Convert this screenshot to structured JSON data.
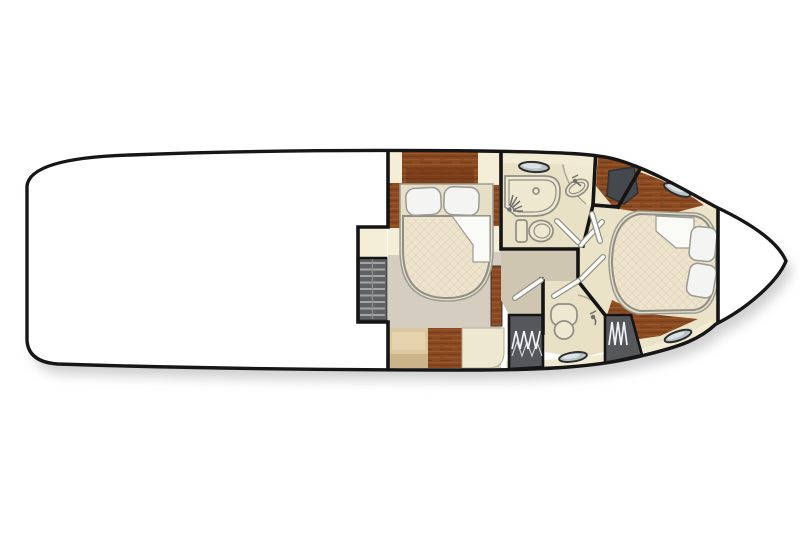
{
  "meta": {
    "title": "Motor yacht lower-deck floor plan, top view with bow facing right",
    "type": "yacht-floor-plan"
  },
  "colors": {
    "hull_fill": "#ffffff",
    "hull_outline": "#161616",
    "shadow": "#a0a0a0",
    "wall": "#141414",
    "floor_mid": "#d5cec0",
    "floor_hall": "#cfc6b2",
    "floor_bath": "#e9e1c5",
    "walkway_cream": "#ebe3c8",
    "square_cream": "#f4eed6",
    "counter_cream": "#f0e9d0",
    "trim_cream": "#f1ebd3",
    "wood": "#8a4a22",
    "wood_dark": "#6e3414",
    "wood_light": "#a65e2e",
    "locker_dark": "#45484c",
    "mattress": "#eee4cd",
    "mattress_line": "#d6cbad",
    "mattress_edge": "#8f8f85",
    "mat_ring": "#e7dec6",
    "pillow": "#f4f4f2",
    "pillow_outline": "#9a9a92",
    "fixture_fill": "#efe8d0",
    "fixture_outline": "#8f8f85",
    "door_leaf": "#fbfbf9",
    "stair_bg": "#5f6163",
    "stair_tread": "#a3a5a7",
    "spring_bg": "#55575b",
    "spring_coil": "#f2f2f2",
    "porthole_rim": "#2e2e2e",
    "porthole_glass": "#b9c3c7",
    "porthole_hi": "#dfe7e9",
    "bench_tan": "#dcc8a0",
    "bench_light": "#e6d4ae",
    "bench_dark": "#cdb389"
  },
  "rooms": [
    {
      "id": "aft-area",
      "label": "Aft deck / saloon (shown empty)"
    },
    {
      "id": "companionway-stairs",
      "label": "Companionway stairs with cream landing"
    },
    {
      "id": "mid-cabin",
      "label": "Midship guest cabin",
      "furniture": [
        "double berth with 2 pillows and turned-down sheet",
        "wood headboard",
        "2 nightstands",
        "bench seat",
        "wood cabinet",
        "side dresser"
      ]
    },
    {
      "id": "day-head",
      "label": "Head with shower",
      "fixtures": [
        "shower stall with sprayer and drain",
        "toilet",
        "washbasin with faucet",
        "porthole"
      ]
    },
    {
      "id": "hallway",
      "label": "Cabin hallway with swinging doors"
    },
    {
      "id": "forward-head",
      "label": "Forward head",
      "fixtures": [
        "toilet",
        "washbasin with faucet",
        "porthole"
      ]
    },
    {
      "id": "forward-cabin",
      "label": "Forward master cabin",
      "furniture": [
        "island double berth with 2 pillows and turned-down sheet",
        "hardwood sole",
        "dark hanging locker",
        "2 portholes"
      ]
    },
    {
      "id": "bow-deck",
      "label": "Bow area (shown empty)"
    }
  ],
  "counts": {
    "portholes": 4,
    "toilets": 2,
    "washbasins": 2,
    "showers": 1,
    "berths": 2,
    "pillows": 4,
    "door_leaves": 6,
    "stair_treads": 9,
    "spring_panels": 2
  }
}
